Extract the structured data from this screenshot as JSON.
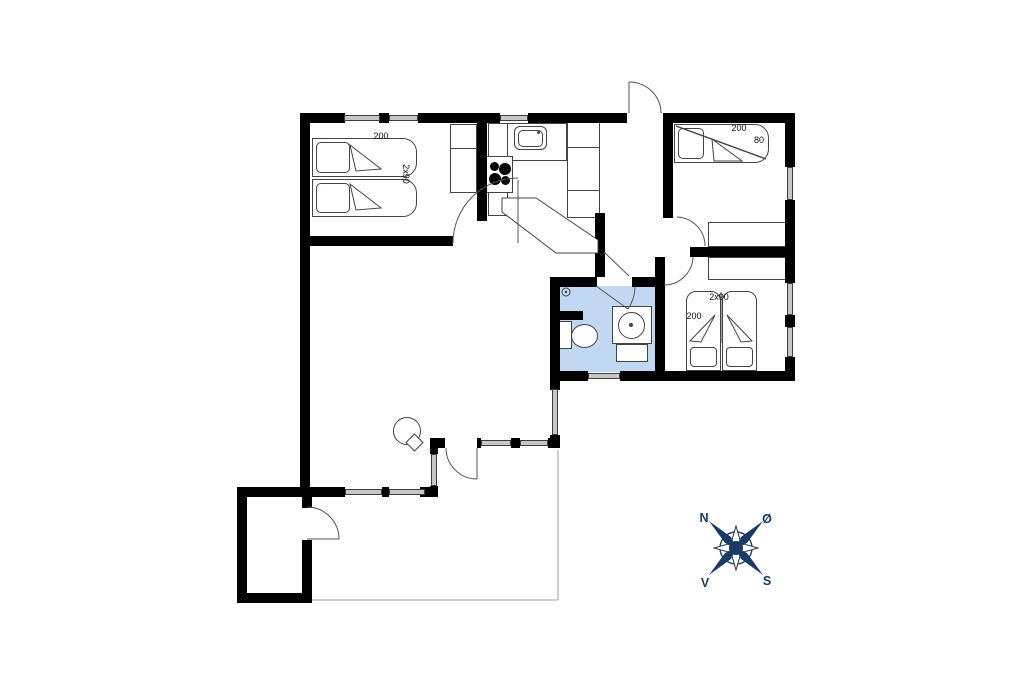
{
  "plan": {
    "type": "house-floor-plan",
    "wall_color": "#000000",
    "window_color": "#c6c6c6",
    "bathroom_floor_color": "#c2d7f2",
    "outline_color": "#444444",
    "terrace_line_color": "#b3b3b3"
  },
  "labels": {
    "bedroom1": {
      "bed_length": "200",
      "bed_width": "2x90"
    },
    "bedroom2": {
      "bed_length": "200",
      "bed_width": "80"
    },
    "bedroom3": {
      "bed_width": "2x90",
      "bed_length": "200"
    }
  },
  "compass": {
    "color": "#1b3a64",
    "north": "N",
    "east": "Ø",
    "south": "S",
    "west": "V"
  }
}
